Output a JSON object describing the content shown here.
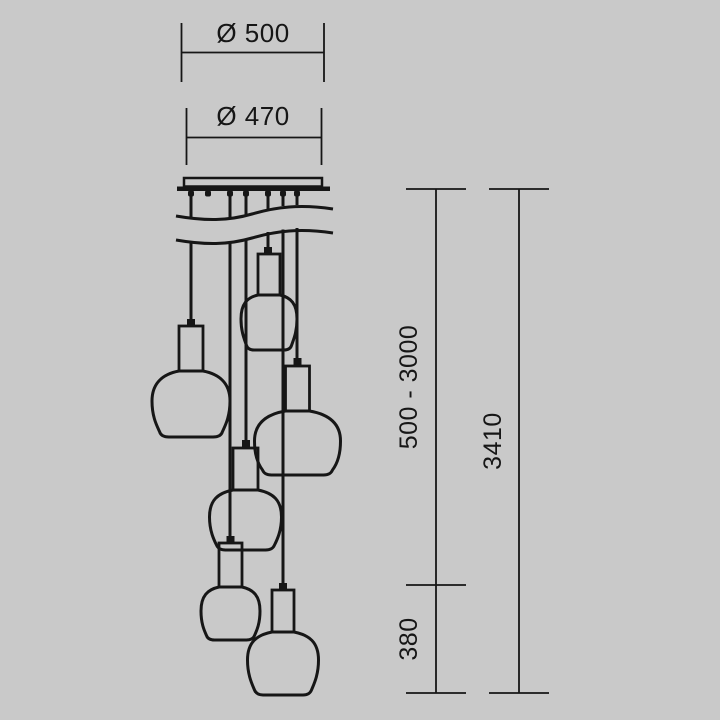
{
  "drawing": {
    "type": "technical-dimension-diagram",
    "subject": "cluster pendant lamp with 6 shades",
    "lamp_count": 6,
    "colors": {
      "background": "#c9c9c9",
      "line": "#161616"
    },
    "dimensions": {
      "canopy_outer_diameter": "Ø 500",
      "canopy_inner_diameter": "Ø 470",
      "adjustable_cord_height": "500 - 3000",
      "overall_height": "3410",
      "lamp_height": "380"
    }
  }
}
